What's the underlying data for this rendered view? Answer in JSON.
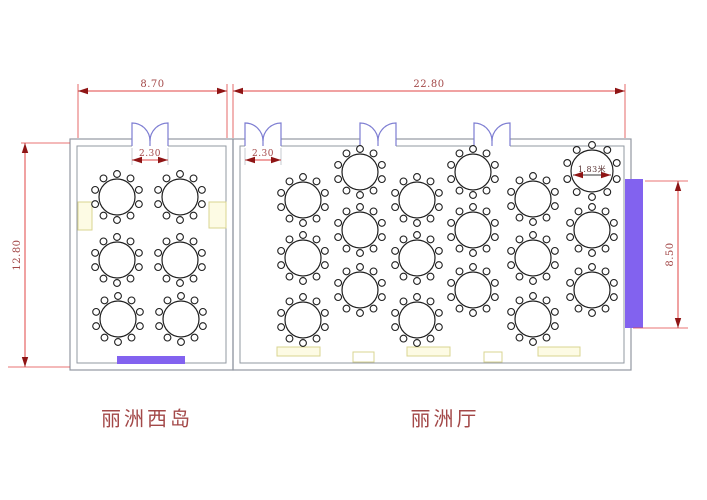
{
  "canvas": {
    "width": 707,
    "height": 500
  },
  "colors": {
    "background": "#ffffff",
    "wall": "#9298a2",
    "door": "#7d7dd2",
    "dim_line": "#e04444",
    "dim_arrow": "#8f1515",
    "dim_text": "#a34848",
    "table_stroke": "#1f1f1f",
    "stage_fill": "#8262ef",
    "counter_fill": "#fdfbe4",
    "counter_border": "#d9d491",
    "label_text": "#a34848"
  },
  "rooms": [
    {
      "id": "west-island",
      "label": "丽洲西岛",
      "outer": [
        70,
        139,
        163,
        231
      ],
      "inner": [
        77,
        146,
        149,
        217
      ],
      "label_pos": [
        147,
        417
      ]
    },
    {
      "id": "main-hall",
      "label": "丽洲厅",
      "outer": [
        233,
        139,
        398,
        231
      ],
      "inner": [
        240,
        146,
        384,
        217
      ],
      "label_pos": [
        445,
        417
      ]
    }
  ],
  "doors": [
    {
      "center": 150,
      "width": 36,
      "dim_label": "2.30"
    },
    {
      "center": 263,
      "width": 36,
      "dim_label": "2.30"
    },
    {
      "center": 378,
      "width": 36,
      "dim_label": ""
    },
    {
      "center": 492,
      "width": 36,
      "dim_label": ""
    }
  ],
  "dimensions": {
    "top": [
      {
        "label": "8.70",
        "x1": 78,
        "x2": 227,
        "y": 91
      },
      {
        "label": "22.80",
        "x1": 233,
        "x2": 625,
        "y": 91
      }
    ],
    "side": [
      {
        "label": "12.80",
        "x": 25,
        "y1": 143,
        "y2": 367,
        "ext": [
          [
            21,
            143,
            70,
            143
          ],
          [
            8,
            367,
            70,
            367
          ]
        ]
      },
      {
        "label": "8.50",
        "x": 678,
        "y1": 181,
        "y2": 328,
        "ext": [
          [
            645,
            181,
            688,
            181
          ],
          [
            633,
            328,
            688,
            328
          ]
        ]
      }
    ],
    "door_dim_y": 160,
    "top_ext_xs": [
      78,
      227,
      233,
      625
    ]
  },
  "tables": {
    "radius": 18,
    "chair_ring": 23,
    "chair_radius": 3.4,
    "chairs_per_table": 10,
    "west_island": [
      [
        117,
        197
      ],
      [
        180,
        197
      ],
      [
        117,
        260
      ],
      [
        180,
        260
      ],
      [
        118,
        319
      ],
      [
        181,
        319
      ]
    ],
    "main_hall": [
      [
        303,
        200
      ],
      [
        303,
        258
      ],
      [
        303,
        320
      ],
      [
        360,
        172
      ],
      [
        360,
        230
      ],
      [
        360,
        290
      ],
      [
        417,
        200
      ],
      [
        417,
        258
      ],
      [
        417,
        320
      ],
      [
        473,
        172
      ],
      [
        473,
        230
      ],
      [
        473,
        290
      ],
      [
        533,
        199
      ],
      [
        533,
        258
      ],
      [
        533,
        319
      ],
      [
        592,
        230
      ],
      [
        592,
        290
      ]
    ],
    "labeled_table": {
      "cx": 592,
      "cy": 171,
      "radius": 21,
      "label": "1.83米"
    }
  },
  "stages": [
    {
      "x": 117,
      "y": 356,
      "w": 68,
      "h": 8
    },
    {
      "x": 625,
      "y": 179,
      "w": 18,
      "h": 149
    }
  ],
  "service_counters": [
    {
      "x": 78,
      "y": 202,
      "w": 14,
      "h": 28
    },
    {
      "x": 209,
      "y": 202,
      "w": 17,
      "h": 26
    },
    {
      "x": 277,
      "y": 347,
      "w": 43,
      "h": 9
    },
    {
      "x": 407,
      "y": 347,
      "w": 43,
      "h": 9
    },
    {
      "x": 538,
      "y": 347,
      "w": 42,
      "h": 9
    }
  ],
  "wall_openings": [
    {
      "x": 353,
      "y": 352,
      "w": 21,
      "h": 10
    },
    {
      "x": 484,
      "y": 352,
      "w": 18,
      "h": 10
    }
  ]
}
